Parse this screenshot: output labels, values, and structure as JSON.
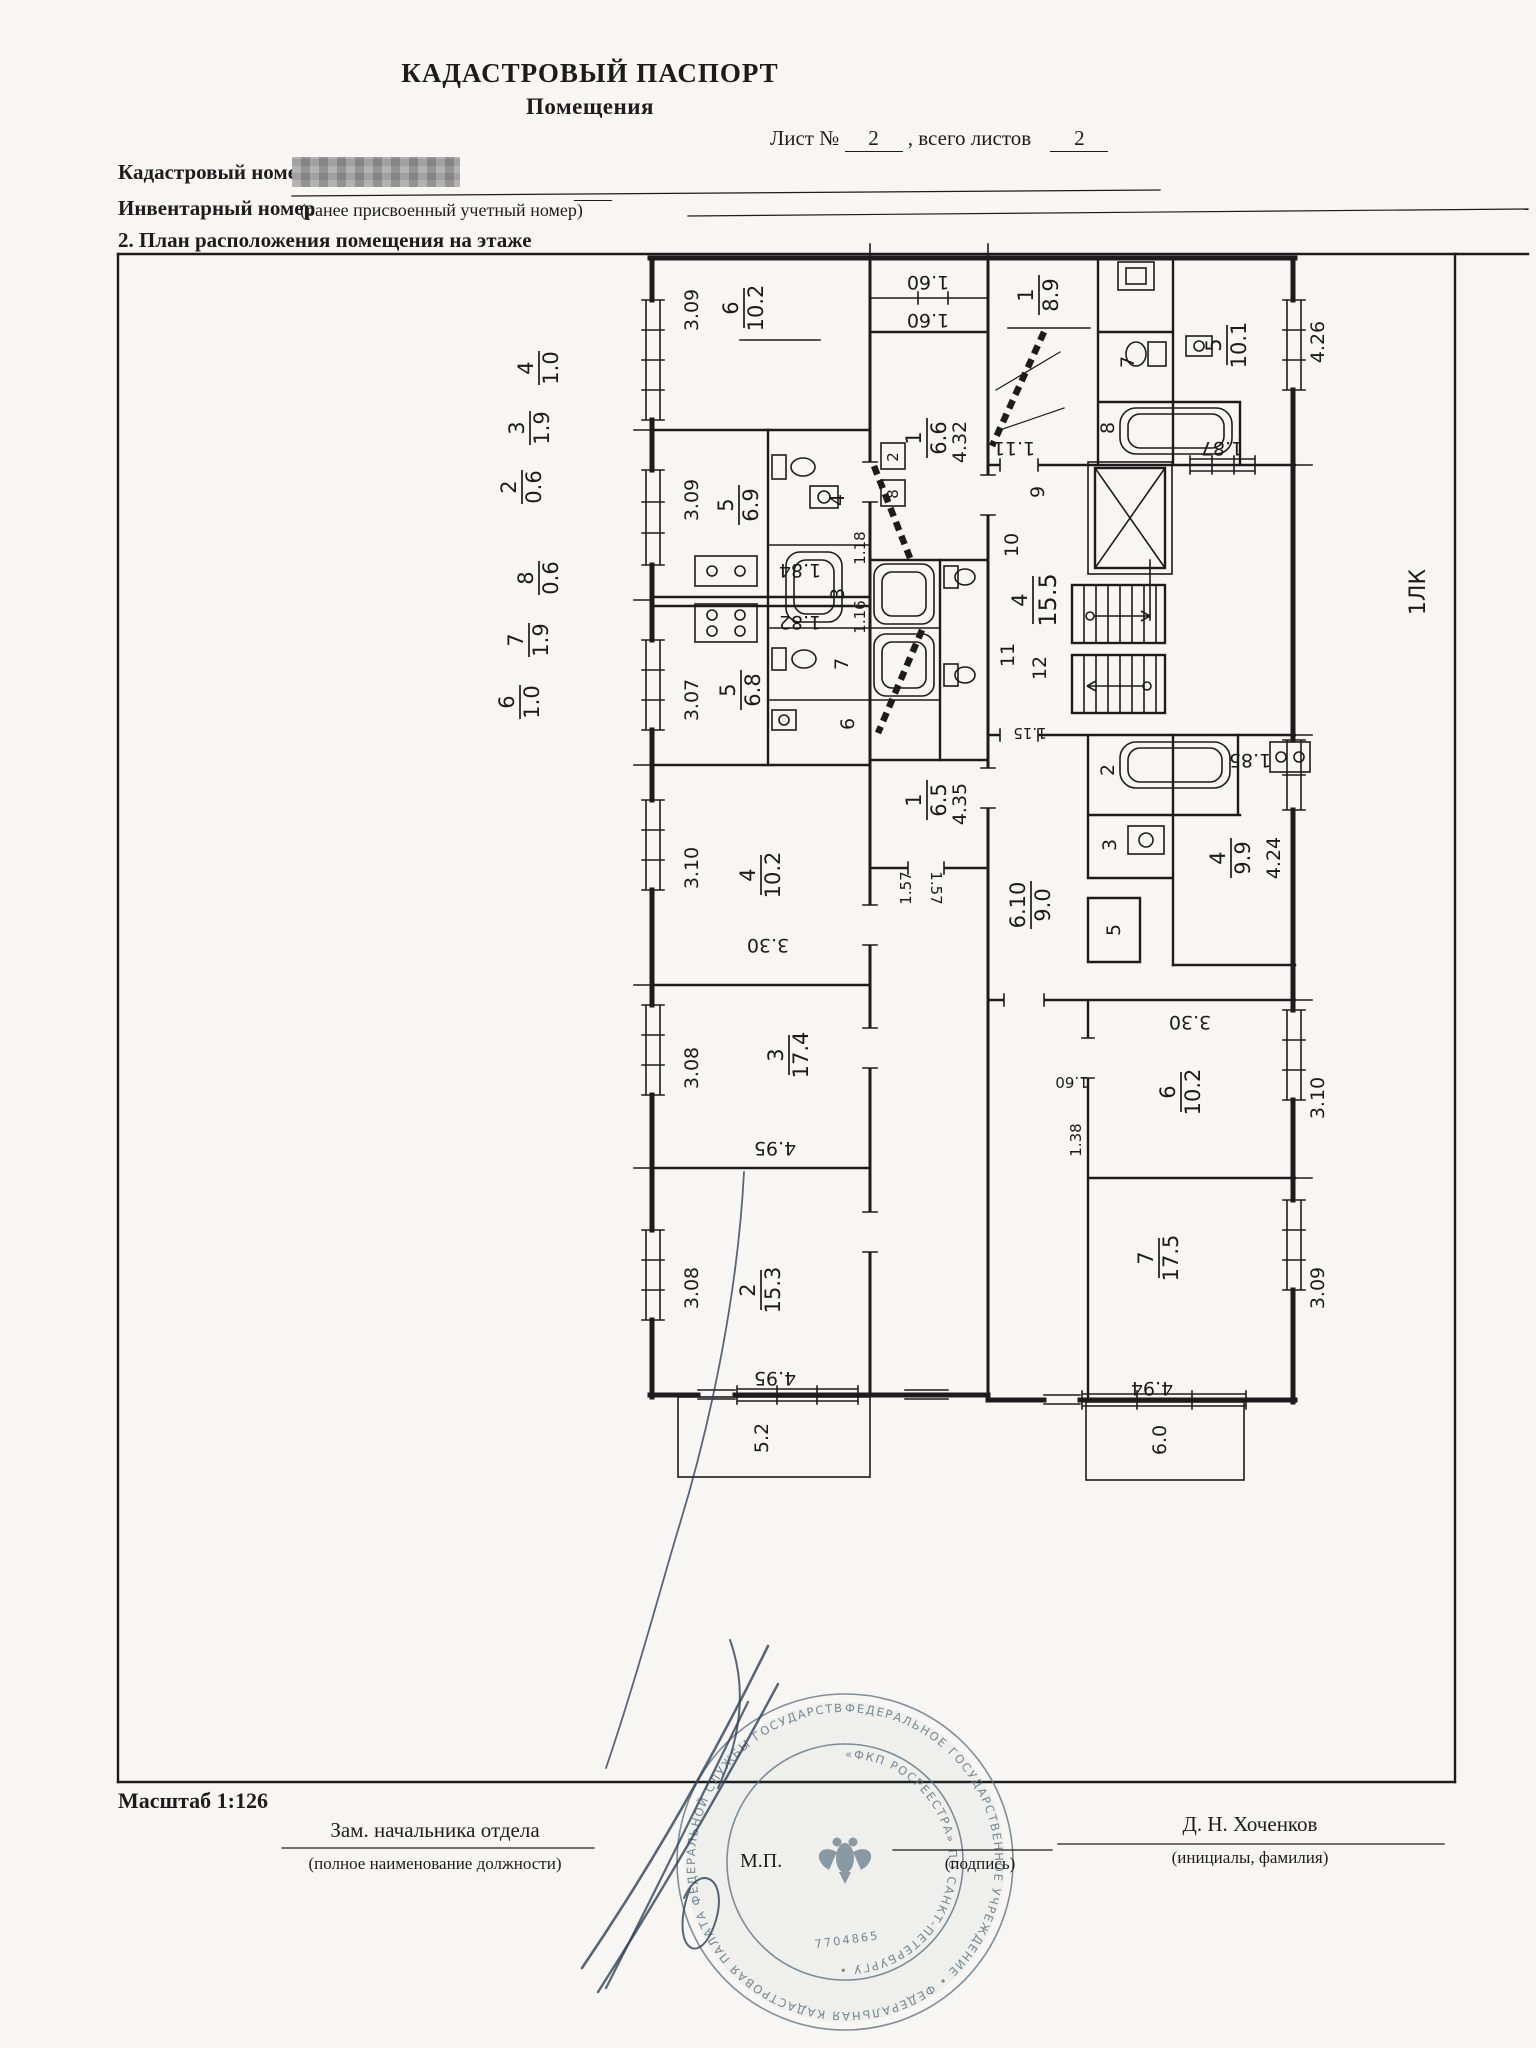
{
  "header": {
    "title_line1": "КАДАСТРОВЫЙ ПАСПОРТ",
    "title_line2": "Помещения",
    "sheet_label": "Лист №",
    "sheet_number": "2",
    "sheet_sep": ",  всего листов",
    "sheet_total": "2"
  },
  "fields": {
    "cadastral_label": "Кадастровый номер",
    "inventory_label": "Инвентарный номер",
    "inventory_note": "(ранее присвоенный учетный номер)",
    "inventory_value": "——",
    "section_heading": "2. План расположения помещения на этаже"
  },
  "plan": {
    "margin_windows": [
      {
        "n": "4",
        "d": "1.0"
      },
      {
        "n": "3",
        "d": "1.9"
      },
      {
        "n": "2",
        "d": "0.6"
      },
      {
        "n": "8",
        "d": "0.6"
      },
      {
        "n": "7",
        "d": "1.9"
      },
      {
        "n": "6",
        "d": "1.0"
      }
    ],
    "rooms": {
      "r6l": {
        "n": "6",
        "d": "10.2"
      },
      "r5a": {
        "n": "5",
        "d": "6.9"
      },
      "r5b": {
        "n": "5",
        "d": "6.8"
      },
      "r4l": {
        "n": "4",
        "d": "10.2"
      },
      "r3l": {
        "n": "3",
        "d": "17.4"
      },
      "r2l": {
        "n": "2",
        "d": "15.3"
      },
      "h66": {
        "n": "1",
        "d": "6.6"
      },
      "h65": {
        "n": "1",
        "d": "6.5"
      },
      "r1r": {
        "n": "1",
        "d": "8.9"
      },
      "r5r": {
        "n": "5",
        "d": "10.1"
      },
      "st": {
        "n": "4",
        "d": "15.5"
      },
      "r4r": {
        "n": "4",
        "d": "9.9"
      },
      "corr": {
        "n": "6.10",
        "d": "9.0"
      },
      "r6r": {
        "n": "6",
        "d": "10.2"
      },
      "r7r": {
        "n": "7",
        "d": "17.5"
      }
    },
    "dims": {
      "w309a": "3.09",
      "w309b": "3.09",
      "w307": "3.07",
      "w310": "3.10",
      "w308a": "3.08",
      "w308b": "3.08",
      "b330": "3.30",
      "b495a": "4.95",
      "b495b": "4.95",
      "c160a": "1.60",
      "c160b": "1.60",
      "h432": "4.32",
      "h435": "4.35",
      "s184": "1.84",
      "s182": "1.82",
      "d157a": "1.57",
      "d157b": "1.57",
      "d118": "1.18",
      "d116": "1.16",
      "d111": "1.11",
      "d115": "1.15",
      "w187": "1.87",
      "w185": "1.85",
      "w426": "4.26",
      "w424": "4.24",
      "r330": "3.30",
      "r310": "3.10",
      "r138": "1.38",
      "r160": "1.60",
      "b494": "4.94",
      "r309": "3.09"
    },
    "balconies": {
      "left": "5.2",
      "right": "6.0"
    },
    "cells": {
      "c4": "4",
      "c3": "3",
      "c7": "7",
      "c6": "6",
      "c2": "2",
      "c8": "8",
      "c9": "9",
      "c10": "10",
      "c11": "11",
      "c12": "12",
      "c5": "5",
      "b7": "7",
      "b8": "8",
      "b2": "2",
      "b3": "3"
    },
    "stair_block": "1ЛК"
  },
  "footer": {
    "scale": "Масштаб 1:126",
    "position_title": "Зам. начальника отдела",
    "position_note": "(полное наименование должности)",
    "stamp_note": "М.П.",
    "signature_note": "(подпись)",
    "signatory": "Д. Н. Хоченков",
    "signatory_note": "(инициалы, фамилия)"
  },
  "stamp": {
    "ring_outer": "ФЕДЕРАЛЬНОЕ ГОСУДАРСТВЕННОЕ УЧРЕЖДЕНИЕ • ФЕДЕРАЛЬНАЯ КАДАСТРОВАЯ ПАЛАТА ФЕДЕРАЛЬНОЙ СЛУЖБЫ ГОСУДАРСТВЕННОЙ РЕГИСТРАЦИИ •",
    "ring_inner": "«ФКП РОСРЕЕСТРА» ПО САНКТ-ПЕТЕРБУРГУ •",
    "number": "7704865"
  }
}
